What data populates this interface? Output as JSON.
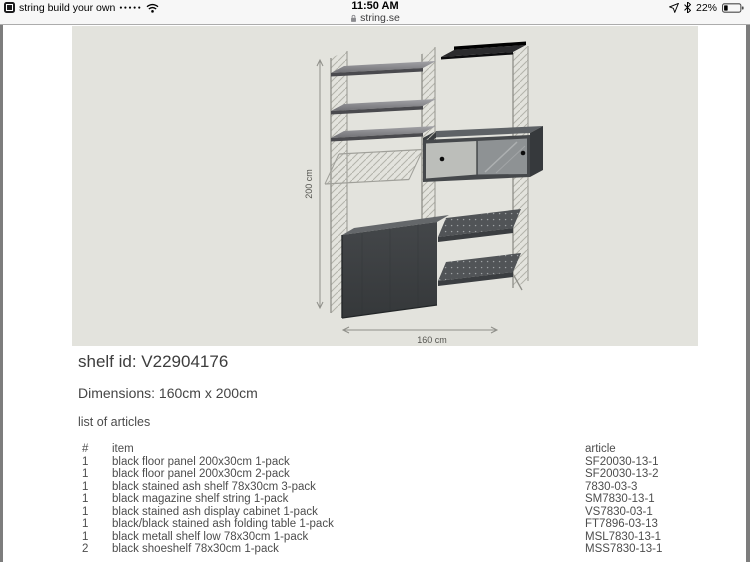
{
  "status_bar": {
    "app_icon": "app-icon",
    "back_app_label": "string build your own",
    "signal_dots": "●●●●●",
    "wifi_icon": "wifi-icon",
    "time": "11:50 AM",
    "lock_icon": "lock-icon",
    "url": "string.se",
    "location_icon": "location-arrow-icon",
    "bluetooth_icon": "bluetooth-icon",
    "battery_percent": "22%",
    "battery_icon": "battery-icon"
  },
  "product": {
    "shelf_id_label": "shelf id: V22904176",
    "dimensions_label": "Dimensions: 160cm x 200cm",
    "list_title": "list of articles"
  },
  "diagram": {
    "height_label": "200 cm",
    "width_label": "160 cm",
    "canvas_color": "#e3e3dd"
  },
  "articles": {
    "headers": {
      "qty": "#",
      "item": "item",
      "article": "article"
    },
    "rows": [
      {
        "qty": "1",
        "item": "black floor panel 200x30cm 1-pack",
        "article": "SF20030-13-1"
      },
      {
        "qty": "1",
        "item": "black floor panel 200x30cm 2-pack",
        "article": "SF20030-13-2"
      },
      {
        "qty": "1",
        "item": "black stained ash shelf 78x30cm 3-pack",
        "article": "7830-03-3"
      },
      {
        "qty": "1",
        "item": "black magazine shelf string 1-pack",
        "article": "SM7830-13-1"
      },
      {
        "qty": "1",
        "item": "black stained ash display cabinet 1-pack",
        "article": "VS7830-03-1"
      },
      {
        "qty": "1",
        "item": "black/black stained ash folding table 1-pack",
        "article": "FT7896-03-13"
      },
      {
        "qty": "1",
        "item": "black metall shelf low 78x30cm 1-pack",
        "article": "MSL7830-13-1"
      },
      {
        "qty": "2",
        "item": "black shoeshelf 78x30cm 1-pack",
        "article": "MSS7830-13-1"
      }
    ]
  },
  "colors": {
    "status_bg": "#f7f7f7",
    "page_bg": "#ffffff",
    "frame_bg": "#7d7d7d",
    "text": "#4b4b4b"
  }
}
